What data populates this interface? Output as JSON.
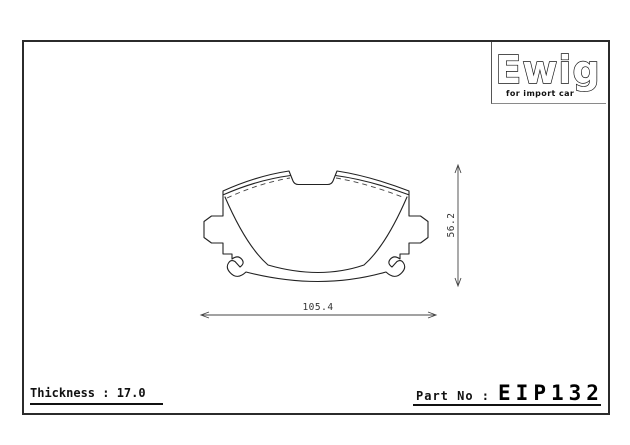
{
  "sheet": {
    "logo": {
      "brand": "Ewig",
      "tagline": "for import car"
    },
    "drawing": {
      "width_dim": "105.4",
      "height_dim": "56.2"
    },
    "footer": {
      "thickness_text": "Thickness : 17.0",
      "part_label": "Part No :",
      "part_number": "EIP132"
    },
    "colors": {
      "line": "#222222",
      "frame": "#2b2b2b"
    }
  }
}
